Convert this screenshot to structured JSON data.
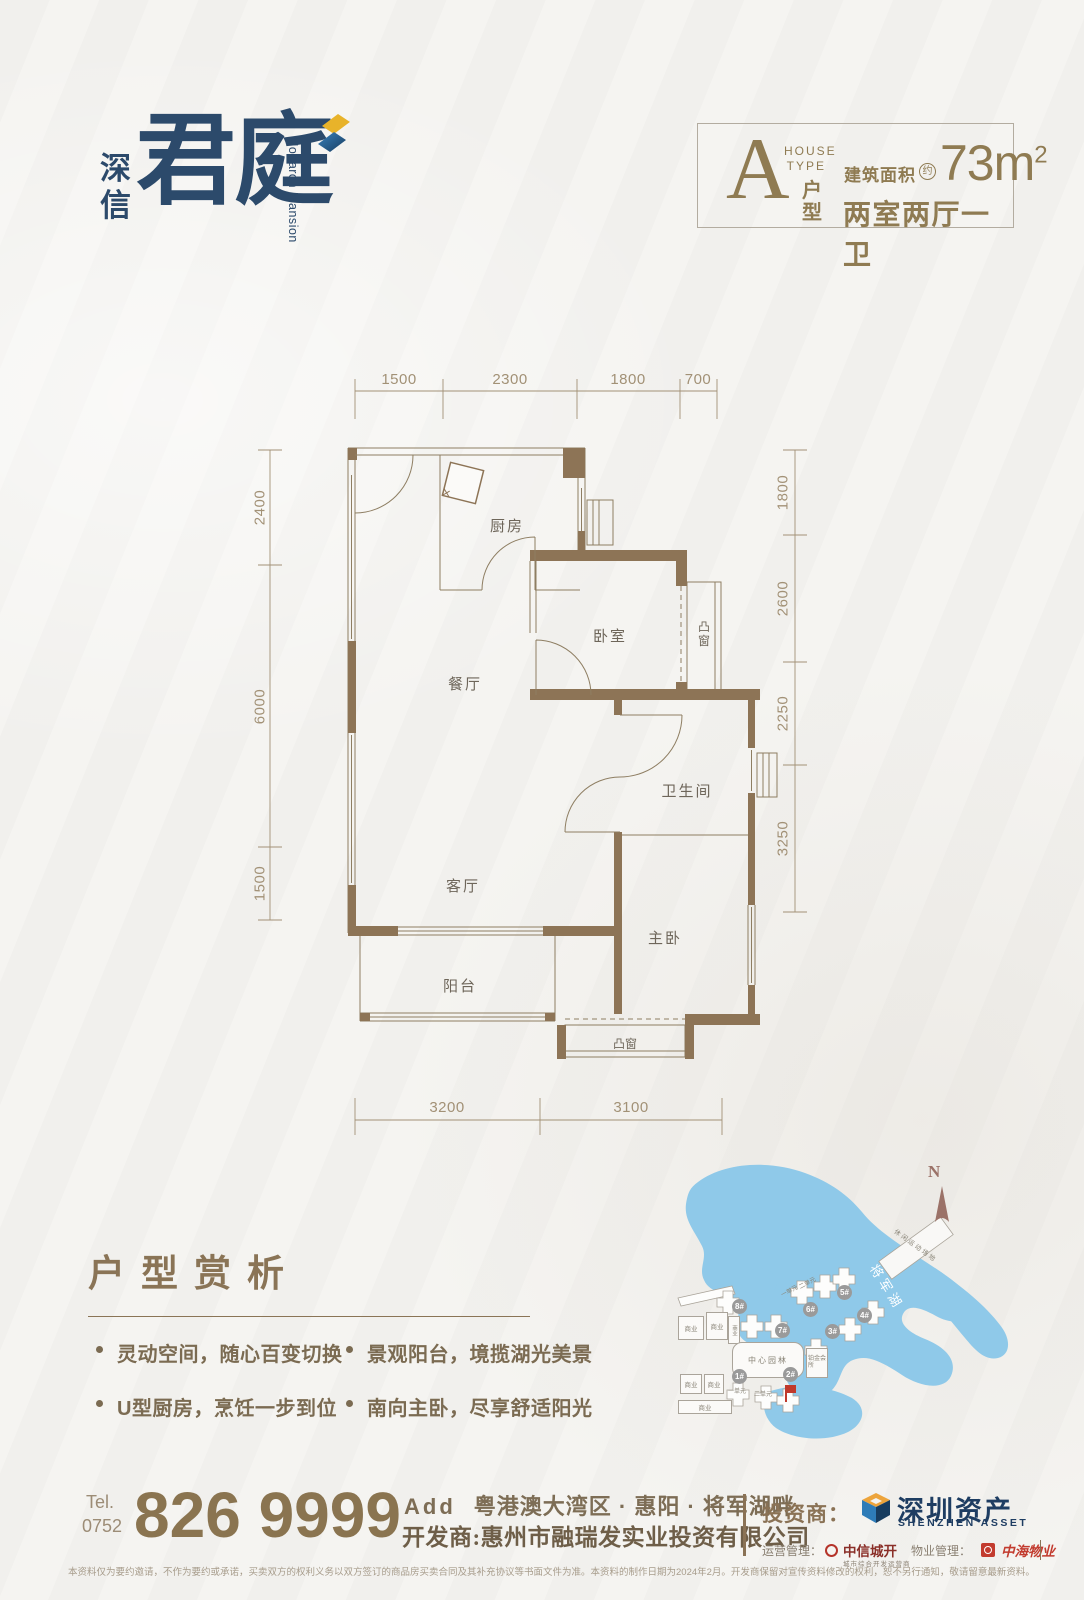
{
  "logo": {
    "cn_vertical": "深信",
    "name": "君庭",
    "en": "Monarch Mansion"
  },
  "type_box": {
    "letter": "A",
    "house_type_line1": "HOUSE",
    "house_type_line2": "TYPE",
    "hu_xing": "户型",
    "area_label": "建筑面积",
    "approx": "约",
    "area_value": "73m",
    "area_sup": "2",
    "rooms_desc": "两室两厅一卫"
  },
  "plan": {
    "dims_top": [
      "1500",
      "2300",
      "1800",
      "700"
    ],
    "dims_left": [
      "2400",
      "6000",
      "1500"
    ],
    "dims_right": [
      "1800",
      "2600",
      "2250",
      "3250"
    ],
    "dims_bottom": [
      "3200",
      "3100"
    ],
    "rooms": {
      "kitchen": "厨房",
      "bedroom": "卧室",
      "dining": "餐厅",
      "bathroom": "卫生间",
      "living": "客厅",
      "master": "主卧",
      "balcony": "阳台",
      "bay_window_right": "凸窗",
      "bay_window_bottom": "凸窗"
    }
  },
  "analysis": {
    "title": "户型赏析",
    "bullets": [
      "灵动空间，随心百变切换",
      "U型厨房，烹饪一步到位",
      "景观阳台，境揽湖光美景",
      "南向主卧，尽享舒适阳光"
    ]
  },
  "sitemap": {
    "north": "N",
    "lake_label": "将军湖",
    "sports_label": "休闲运动场地",
    "garden_label": "中心园林",
    "club_label": "铂金会所",
    "commercial_label": "商业",
    "unit1": "一单元",
    "unit2": "二单元",
    "buildings": [
      "1#",
      "2#",
      "3#",
      "4#",
      "5#",
      "6#",
      "7#",
      "8#"
    ]
  },
  "footer": {
    "tel_label": "Tel.",
    "tel_code": "0752",
    "tel_number": "826 9999",
    "add_label": "Add",
    "address": "粤港澳大湾区 · 惠阳 · 将军湖畔",
    "developer": "开发商:惠州市融瑞发实业投资有限公司",
    "investor_label": "投资商：",
    "investor_name": "深圳资产",
    "investor_en": "SHENZHEN ASSET",
    "op_label": "运营管理：",
    "op_name": "中信城开",
    "op_sub": "城市综合开发运营商",
    "pm_label": "物业管理：",
    "pm_name": "中海物业",
    "disclaimer": "本资料仅为要约邀请，不作为要约或承诺，买卖双方的权利义务以双方签订的商品房买卖合同及其补充协议等书面文件为准。本资料的制作日期为2024年2月。开发商保留对宣传资料修改的权利，恕不另行通知，敬请留意最新资料。"
  },
  "colors": {
    "accent_brown": "#8A7456",
    "brand_navy": "#2C4A6B",
    "lake_blue": "#8FC9E9",
    "logo_yellow": "#E8B32A",
    "logo_blue": "#2E7CB8",
    "red_marker": "#C0392B",
    "pm_red": "#C23B2E"
  }
}
